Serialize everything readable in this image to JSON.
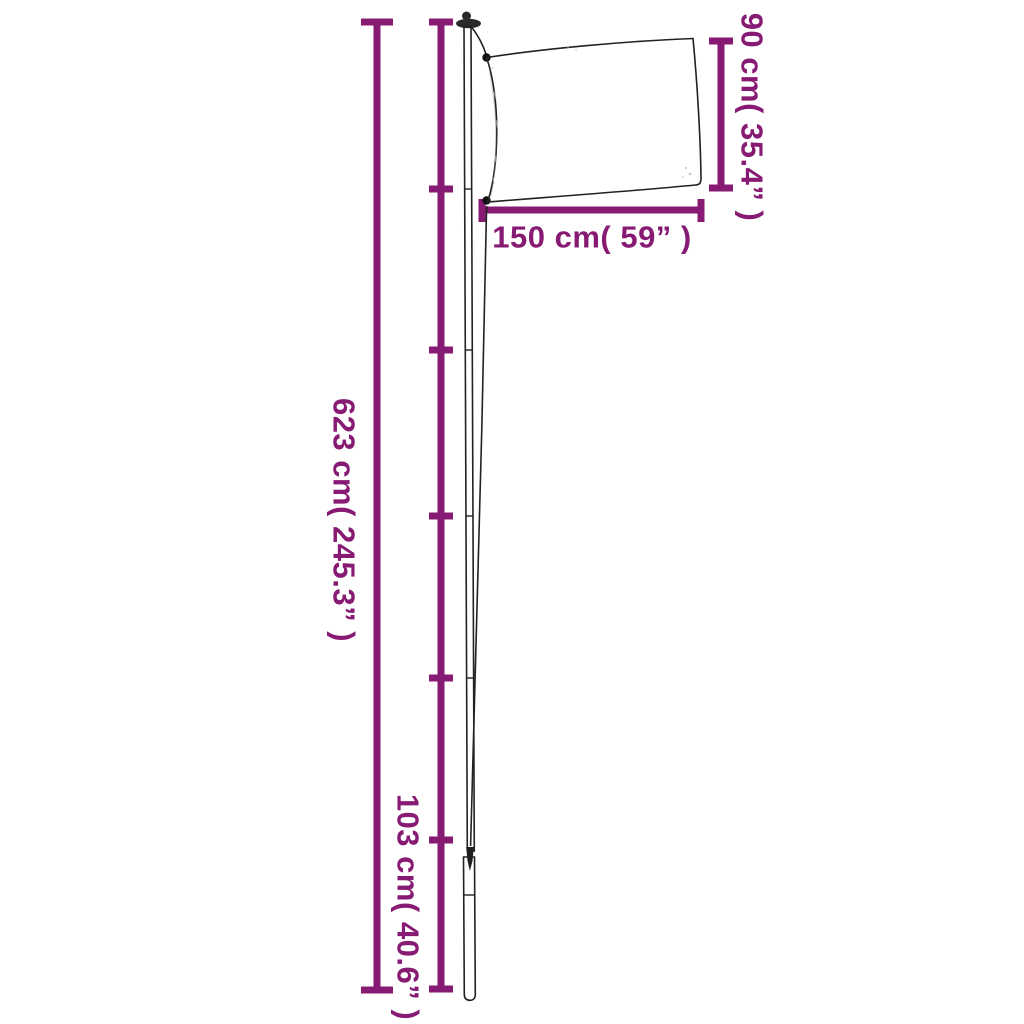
{
  "colors": {
    "accent": "#871A73",
    "ink": "#222222",
    "background": "#FFFFFF"
  },
  "measurements": {
    "total_height": {
      "label": "623 cm( 245.3” )",
      "orientation": "vertical"
    },
    "section_height": {
      "label": "103 cm( 40.6” )",
      "orientation": "vertical"
    },
    "flag_height": {
      "label": "90 cm( 35.4” )",
      "orientation": "vertical"
    },
    "flag_width": {
      "label": "150 cm( 59” )",
      "orientation": "horizontal"
    }
  }
}
